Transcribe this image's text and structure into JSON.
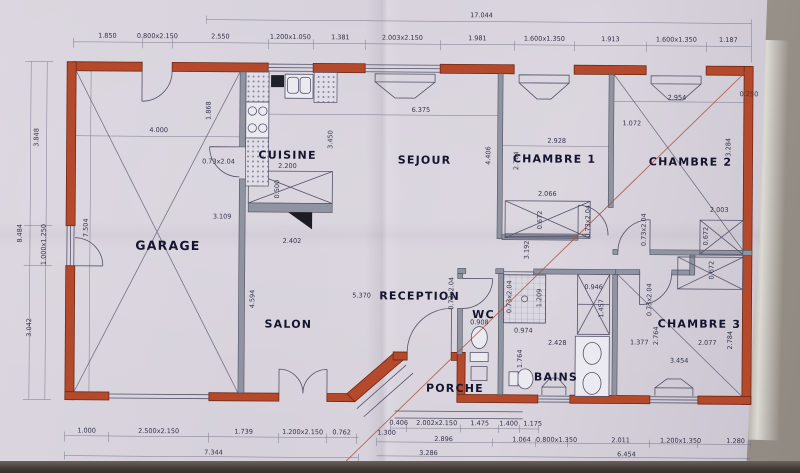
{
  "rooms": {
    "garage": "GARAGE",
    "cuisine": "CUISINE",
    "sejour": "SEJOUR",
    "chambre1": "CHAMBRE 1",
    "chambre2": "CHAMBRE 2",
    "chambre3": "CHAMBRE 3",
    "salon": "SALON",
    "reception": "RECEPTION",
    "wc": "WC",
    "bains": "BAINS",
    "porche": "PORCHE"
  },
  "dims": {
    "total_top": "17.044",
    "top": [
      "1.850",
      "0.800x2.150",
      "2.550",
      "1.200x1.050",
      "1.381",
      "2.003x2.150",
      "1.981",
      "1.600x1.350",
      "1.913",
      "1.600x1.350",
      "1.187"
    ],
    "left": [
      "3.848",
      "1.000x1.250",
      "3.042"
    ],
    "left_total": "8.484",
    "bottom_left": [
      "1.000",
      "2.500x2.150",
      "1.739",
      "1.200x2.150",
      "0.762",
      "1.300"
    ],
    "bottom_left_total": "7.344",
    "bottom_mid": [
      "0.406",
      "2.002x2.150",
      "1.475",
      "1.400",
      "1.175"
    ],
    "bottom_mid_total": "3.286",
    "bottom_right": [
      "2.896",
      "1.064",
      "0.800x1.350",
      "2.011",
      "1.200x1.350",
      "1.280"
    ],
    "bottom_right_total": "6.454",
    "garage_w": "4.000",
    "garage_h": "7.504",
    "garage_diag": "3.109",
    "cuisine_counter": "1.868",
    "cuisine_h": "3.450",
    "island_w": "2.200",
    "island_d": "0.500",
    "door": "0.73x2.04",
    "sejour_w": "6.375",
    "sejour_h": "4.406",
    "ch1_w": "2.928",
    "ch1_h": "2.764",
    "closet1_w": "2.066",
    "closet1_d": "0.672",
    "ch2_w": "2.954",
    "right_top": "0.250",
    "ch2_h": "3.284",
    "ch2_stub": "1.072",
    "ch2_closet": "2.003",
    "ch2_closet_d": "0.672",
    "ch3_w": "2.077",
    "ch3_h": "2.784",
    "ch3_w2": "3.454",
    "ch3_d1": "1.377",
    "ch3_d2": "2.764",
    "ch3_closet_d": "0.672",
    "reception_w": "5.370",
    "hall_h": "3.192",
    "salon_w": "2.402",
    "salon_h": "4.594",
    "wc_w": "0.908",
    "bains_w": "2.428",
    "bains_h": "1.764",
    "shower_w": "0.974",
    "shower_h": "1.209",
    "bcloset_w": "0.946",
    "bcloset_h": "1.457"
  },
  "colors": {
    "wall": "#b5492c",
    "paper": "#d8d3dd",
    "line": "#5c5c72"
  }
}
